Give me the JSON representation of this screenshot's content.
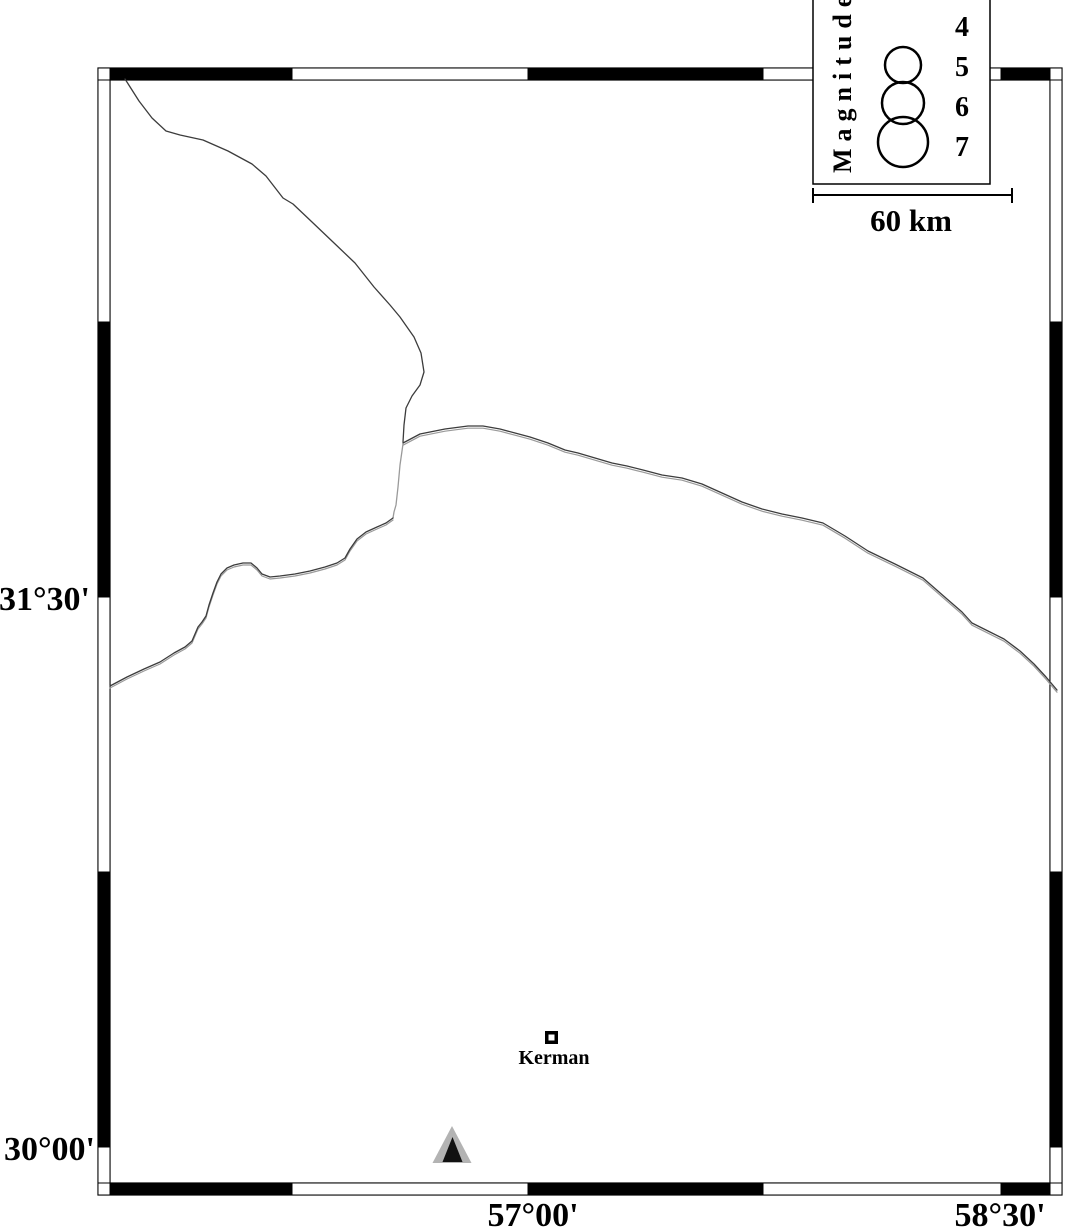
{
  "map": {
    "background_color": "#ffffff",
    "ink_color": "#000000",
    "line_color": "#3c3c3c",
    "line_secondary_color": "#9a9a9a",
    "lat_labels": [
      {
        "text": "31°30'"
      },
      {
        "text": "30°00'"
      }
    ],
    "lon_labels": [
      {
        "text": "57°00'"
      },
      {
        "text": "58°30'"
      }
    ],
    "city": {
      "label": "Kerman"
    },
    "station": {
      "fill_color": "#b3b3b3",
      "core_color": "#111111"
    }
  },
  "legend": {
    "title": "Magnitude",
    "entries": [
      {
        "label": "4"
      },
      {
        "label": "5",
        "radius": 18
      },
      {
        "label": "6",
        "radius": 21
      },
      {
        "label": "7",
        "radius": 25
      }
    ],
    "scale_label": "60 km"
  }
}
